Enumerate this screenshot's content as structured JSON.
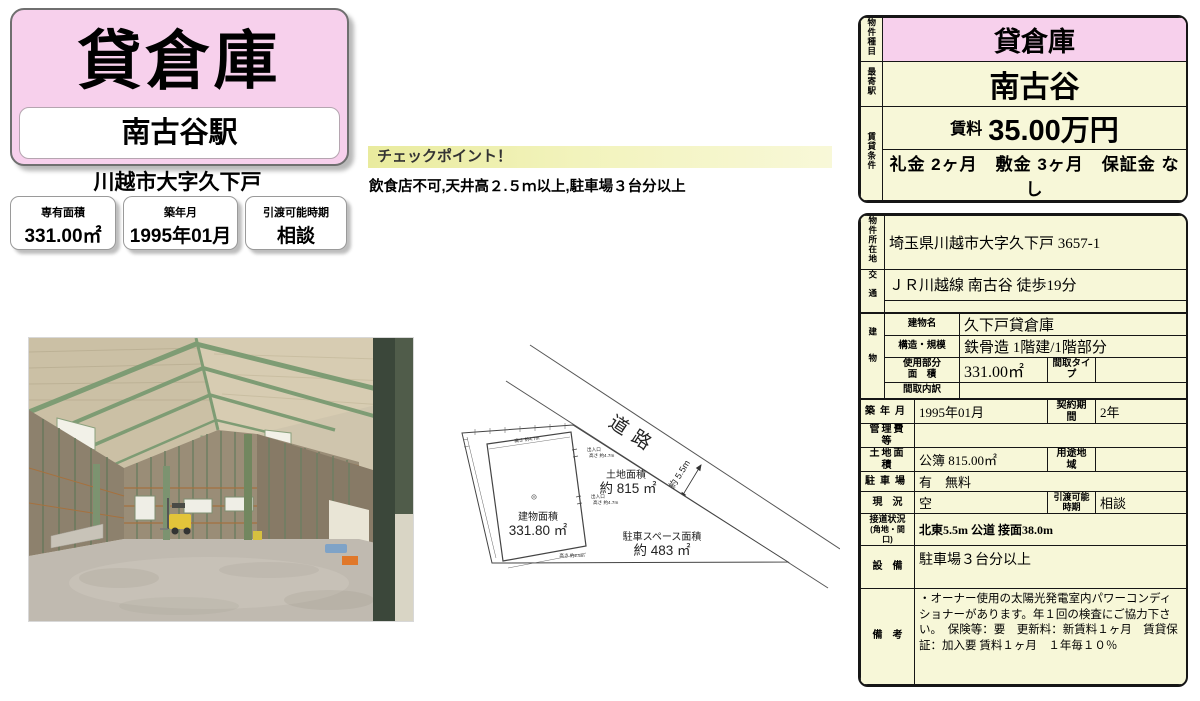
{
  "header": {
    "title": "貸倉庫",
    "station": "南古谷駅",
    "address": "川越市大字久下戸",
    "stats": [
      {
        "label": "専有面積",
        "value": "331.00㎡"
      },
      {
        "label": "築年月",
        "value": "1995年01月"
      },
      {
        "label": "引渡可能時期",
        "value": "相談"
      }
    ]
  },
  "checkpoint": {
    "title": "チェックポイント！",
    "text": "飲食店不可,天井高２.５ｍ以上,駐車場３台分以上"
  },
  "summary": {
    "type_label": "物件種目",
    "type_value": "貸倉庫",
    "station_label": "最寄駅",
    "station_value": "南古谷",
    "terms_label": "賃貸条件",
    "rent_label": "賃料",
    "rent_value": "35.00万円",
    "fees": "礼金 2ヶ月　敷金 3ヶ月　保証金 なし"
  },
  "details": {
    "location_label": "物件所在地",
    "location": "埼玉県川越市大字久下戸 3657-1",
    "transport_label": "交通",
    "transport": "ＪＲ川越線 南古谷 徒歩19分",
    "building_label": "建物",
    "building_name_label": "建物名",
    "building_name": "久下戸貸倉庫",
    "structure_label": "構造・規模",
    "structure": "鉄骨造 1階建/1階部分",
    "used_area_label1": "使用部分",
    "used_area_label2": "面　積",
    "used_area": "331.00㎡",
    "madori_type_label": "間取タイプ",
    "madori_type": "",
    "madori_detail_label": "間取内訳",
    "madori_detail": "",
    "built_label": "築年月",
    "built": "1995年01月",
    "contract_label": "契約期間",
    "contract": "2年",
    "mgmt_fee_label": "管理費等",
    "mgmt_fee": "",
    "land_label": "土地面積",
    "land": "公簿 815.00㎡",
    "zoning_label": "用途地域",
    "zoning": "",
    "parking_label": "駐車場",
    "parking": "有　無料",
    "status_label": "現　況",
    "status": "空",
    "handover_label1": "引渡可能",
    "handover_label2": "時期",
    "handover": "相談",
    "frontage_label1": "接道状況",
    "frontage_label2": "(角地・間口)",
    "frontage": "北東5.5m 公道 接面38.0m",
    "facilities_label": "設　備",
    "facilities": "駐車場３台分以上",
    "notes_label": "備　考",
    "notes": "・オーナー使用の太陽光発電室内パワーコンディショナーがあります。年１回の検査にご協力下さい。　保険等：要　更新料：新賃料１ヶ月　賃貸保証：加入要 賃料１ヶ月　１年毎１０％"
  },
  "plan": {
    "road": "道路",
    "road_width": "約 5.5m",
    "land_label": "土地面積",
    "land_value": "約 815 ㎡",
    "building_label": "建物面積",
    "building_value": "331.80 ㎡",
    "parking_label": "駐車スペース面積",
    "parking_value": "約 483 ㎡",
    "entrance": "出入口",
    "entrance_height": "高さ 約4.7m",
    "top_height": "高さ 約4.7m",
    "bottom_height": "高さ 約2.5m"
  },
  "colors": {
    "pink": "#f7d0ec",
    "cream": "#f7f7d8",
    "banner_yellow": "#e9eb9e"
  }
}
